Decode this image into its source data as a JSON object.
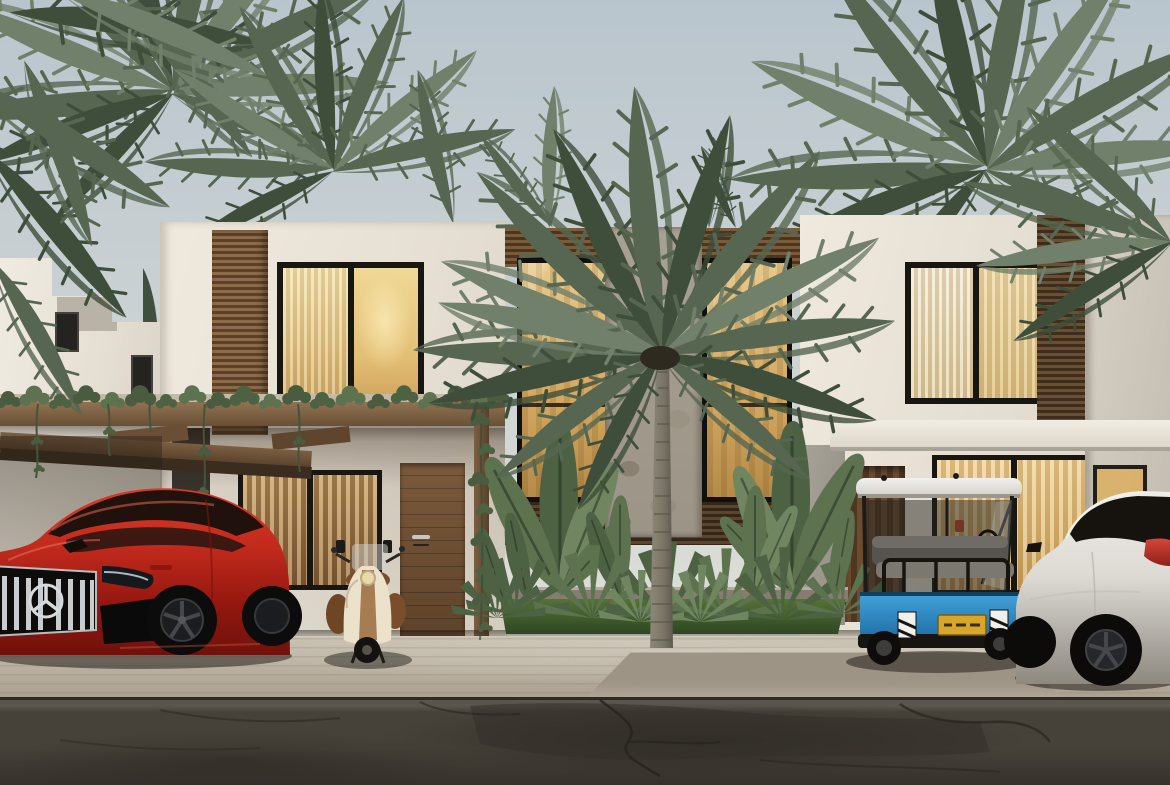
{
  "scene": {
    "description": "Photorealistic dusk 3D rendering of a modern two-story tropical townhouse complex with wood-slat and stone facade accents, warmly lit windows, palm trees, a front garden, a red luxury coupe SUV, a vintage scooter, a blue golf cart and a white SUV parked along a cracked asphalt road",
    "setting": "tropical residential street at dusk"
  },
  "objects": {
    "sky": {
      "label": "overcast dusk sky"
    },
    "background_palms": {
      "label": "palm trees behind the buildings"
    },
    "background_building": {
      "label": "neighboring white villa"
    },
    "main_building": {
      "label": "two-story modern townhouse building"
    },
    "left_unit": {
      "label": "left townhouse unit with lit windows"
    },
    "center_section": {
      "label": "central double-height glazing with stone-clad column"
    },
    "right_unit": {
      "label": "right townhouse unit with lit windows"
    },
    "pergola": {
      "label": "vine-covered wooden pergola carport"
    },
    "front_door": {
      "label": "wooden entry door"
    },
    "garden": {
      "label": "tropical planting bed with grass strip"
    },
    "front_palm": {
      "label": "large palm tree in front of the facade"
    },
    "red_suv": {
      "label": "red luxury coupe SUV with chrome slat grille and three-pointed star"
    },
    "scooter": {
      "label": "vintage cream and brown scooter"
    },
    "golf_cart": {
      "label": "blue golf cart with white roof and yellow license plate"
    },
    "white_suv": {
      "label": "white SUV with red taillights"
    },
    "driveway": {
      "label": "light concrete driveway with curb ramp"
    },
    "road": {
      "label": "dark cracked asphalt road"
    }
  },
  "palette": {
    "sky_top": "#b9c5cd",
    "sky_mid": "#cdd3d4",
    "sky_bottom": "#dcded7",
    "facade": "#ece6da",
    "facade_shade": "#dcd5c8",
    "slat_light": "#8a6b4a",
    "slat_dark": "#5c4027",
    "slat_deep": "#3f2d1b",
    "wood_beam": "#8f7352",
    "door_wood": "#6e4f33",
    "stone": "#a49d8f",
    "frame_dark": "#15130f",
    "glow": "#e5c47f",
    "glow_deep": "#b98d4e",
    "curtain": "#f2dda2",
    "palm_dark": "#3f4e3a",
    "palm_mid": "#566650",
    "palm_light": "#70806a",
    "vine": "#4a5c40",
    "grass": "#3f5c30",
    "plant": "#4c6242",
    "trunk": "#847e70",
    "car_red": "#c22a1c",
    "car_red_deep": "#7e1510",
    "glass_dark": "#1c1410",
    "chrome": "#cfd2d4",
    "scooter_cream": "#e3d9c4",
    "scooter_brown": "#8a5a33",
    "cart_blue": "#2f93d0",
    "cart_blue_deep": "#1e6ca6",
    "cart_roof": "#ecebe7",
    "seat_gray": "#6f6c66",
    "plate_yellow": "#d8a62c",
    "suv_white": "#e6e3dd",
    "suv_shade": "#b7b3ac",
    "taillight": "#b5372b",
    "driveway": "#b9b1a3",
    "driveway_light": "#cdc6b8",
    "ramp": "#9b9285",
    "road": "#454039",
    "road_dark": "#322e29",
    "crack": "#262320",
    "shadow": "#241f1a"
  }
}
